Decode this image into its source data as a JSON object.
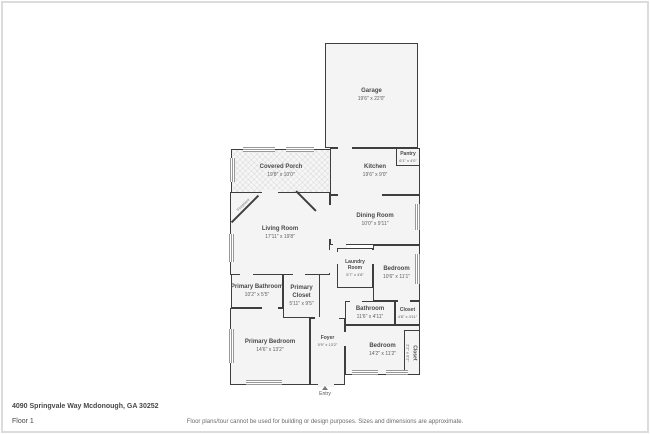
{
  "page": {
    "address": "4090 Springvale Way Mcdonough, GA 30252",
    "floor_label": "Floor 1",
    "disclaimer": "Floor plans/tour cannot be used for building or design purposes. Sizes and dimensions are approximate."
  },
  "plan": {
    "entry_label": "Entry",
    "fireplace_label": "Fireplace",
    "icons": {
      "entry": "up-triangle"
    },
    "colors": {
      "wall": "#3e3e3e",
      "room_fill": "#f4f4f4",
      "text": "#4a4a4a",
      "background": "#ffffff"
    },
    "rooms": {
      "garage": {
        "name": "Garage",
        "dims": "19'6\" x 22'0\""
      },
      "covered_porch": {
        "name": "Covered Porch",
        "dims": "19'8\" x 10'0\""
      },
      "pantry": {
        "name": "Pantry",
        "dims": "6'1\" x 4'0\""
      },
      "kitchen": {
        "name": "Kitchen",
        "dims": "19'6\" x 9'0\""
      },
      "dining_room": {
        "name": "Dining Room",
        "dims": "10'0\" x 9'11\""
      },
      "living_room": {
        "name": "Living Room",
        "dims": "17'11\" x 19'8\""
      },
      "laundry_room": {
        "name": "Laundry Room",
        "dims": "5'7\" x 4'8\""
      },
      "bedroom_mid": {
        "name": "Bedroom",
        "dims": "10'6\" x 11'1\""
      },
      "primary_bathroom": {
        "name": "Primary Bathroom",
        "dims": "10'2\" x 5'5\""
      },
      "primary_closet": {
        "name": "Primary Closet",
        "dims": "5'11\" x 9'5\""
      },
      "bathroom": {
        "name": "Bathroom",
        "dims": "11'6\" x 4'11\""
      },
      "closet": {
        "name": "Closet",
        "dims": "4'8\" x 4'11\""
      },
      "primary_bedroom": {
        "name": "Primary Bedroom",
        "dims": "14'6\" x 13'2\""
      },
      "foyer": {
        "name": "Foyer",
        "dims": "5'9\" x 13'2\""
      },
      "bedroom_bottom": {
        "name": "Bedroom",
        "dims": "14'2\" x 11'2\""
      },
      "closet_vertical": {
        "name": "Closet",
        "dims": "2'2\" x 9'2\""
      }
    }
  }
}
